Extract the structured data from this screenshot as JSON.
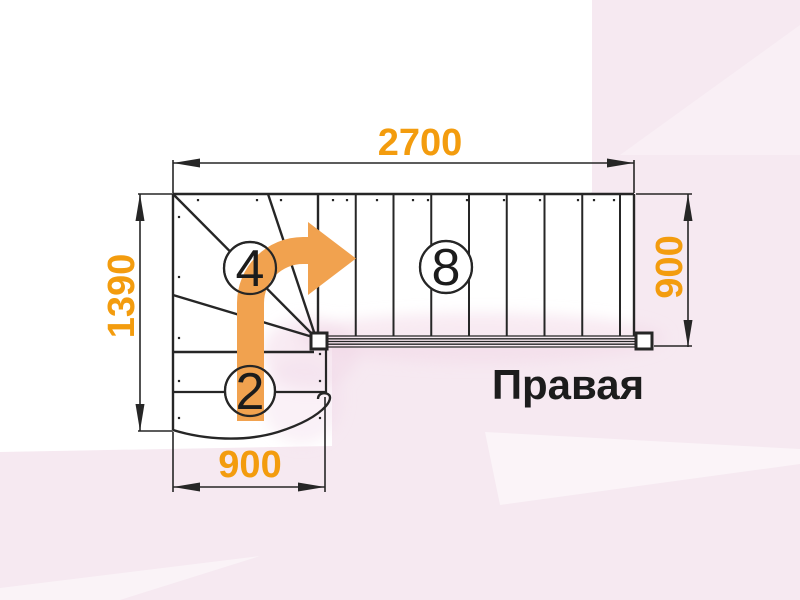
{
  "diagram": {
    "type": "stair-plan",
    "orientation_label": "Правая",
    "dimensions": {
      "top_width": "2700",
      "left_height": "1390",
      "right_height": "900",
      "bottom_width": "900"
    },
    "step_counts": {
      "winder": "4",
      "upper_flight": "8",
      "lower_flight": "2"
    },
    "colors": {
      "dimension_text_orange": "#F39C0E",
      "arrow_orange": "#F1A24F",
      "line_dark": "#262626",
      "background_pink": "#F6E9F1",
      "label_dark": "#1C1C1C"
    },
    "icons": {
      "direction_arrow": "curved-up-right-arrow"
    }
  }
}
